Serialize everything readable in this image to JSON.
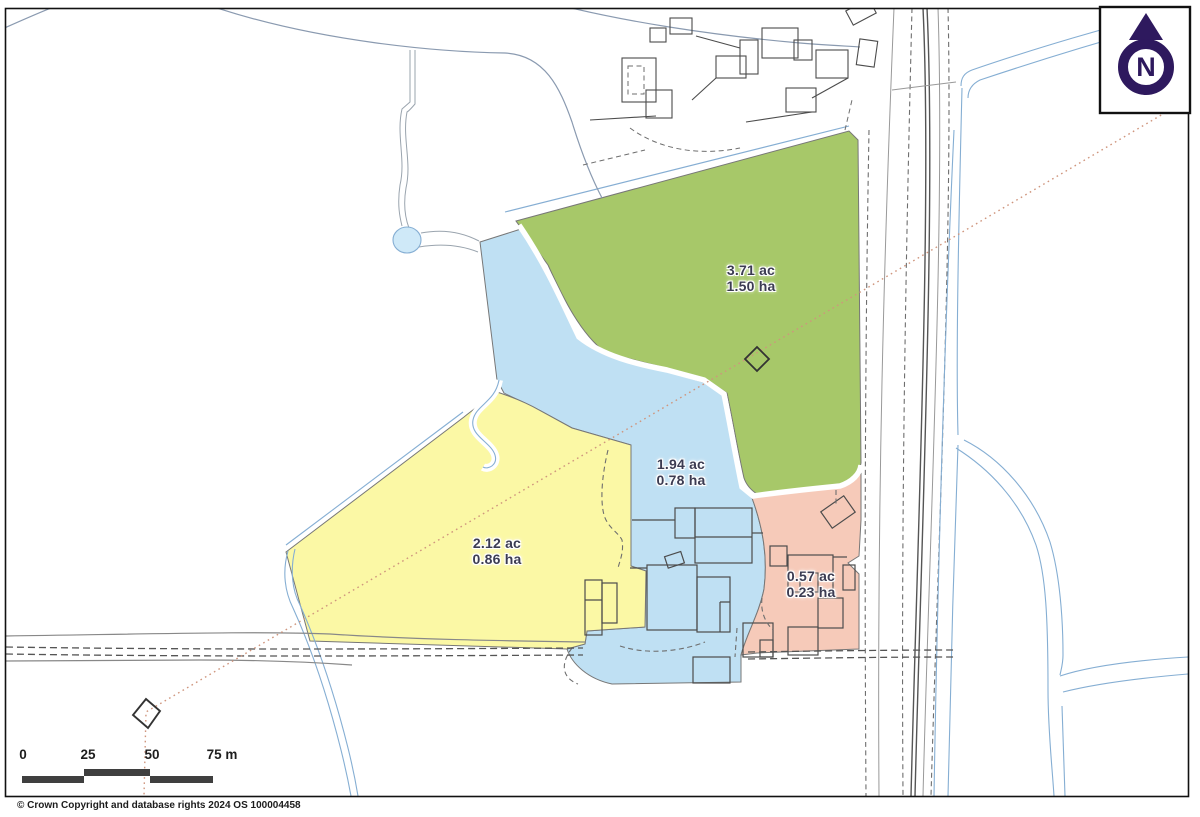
{
  "map": {
    "parcels": [
      {
        "name": "green parcel",
        "acres": "3.71 ac",
        "hectares": "1.50 ha",
        "color": "#a7c869"
      },
      {
        "name": "blue parcel",
        "acres": "1.94 ac",
        "hectares": "0.78 ha",
        "color": "#bfe0f3"
      },
      {
        "name": "yellow parcel",
        "acres": "2.12 ac",
        "hectares": "0.86 ha",
        "color": "#fbf8a5"
      },
      {
        "name": "pink parcel",
        "acres": "0.57 ac",
        "hectares": "0.23 ha",
        "color": "#f6cab9"
      }
    ],
    "north": {
      "label": "N",
      "color": "#2e195e"
    },
    "scale_bar": {
      "labels": [
        "0",
        "25",
        "50",
        "75 m"
      ],
      "bar_color": "#3f3f3f"
    },
    "copyright": "© Crown Copyright and database rights 2024 OS 100004458"
  }
}
